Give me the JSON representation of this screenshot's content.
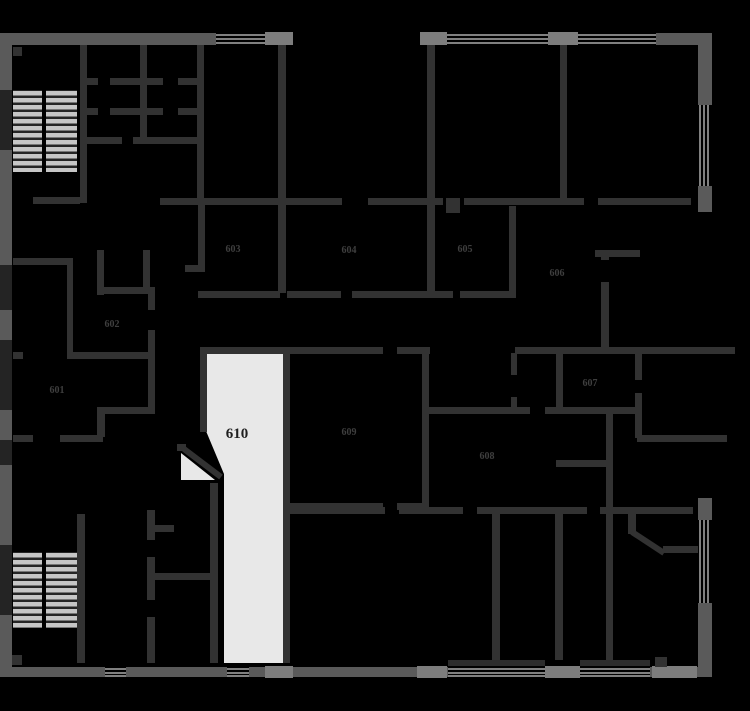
{
  "plan": {
    "type": "floor-plan",
    "highlighted_room": "610",
    "rooms": [
      {
        "id": "601",
        "label": "601"
      },
      {
        "id": "602",
        "label": "602"
      },
      {
        "id": "603",
        "label": "603"
      },
      {
        "id": "604",
        "label": "604"
      },
      {
        "id": "605",
        "label": "605"
      },
      {
        "id": "606",
        "label": "606"
      },
      {
        "id": "607",
        "label": "607"
      },
      {
        "id": "608",
        "label": "608"
      },
      {
        "id": "609",
        "label": "609"
      },
      {
        "id": "610",
        "label": "610"
      }
    ]
  },
  "colors": {
    "background": "#000000",
    "inner_wall": "#323232",
    "outer_wall": "#5a5a5a",
    "pier": "#7d7d7d",
    "window_line": "#808080",
    "stair_tread": "#c6c6c6",
    "stair_gap": "#252525",
    "highlight_room_fill": "#e8e8e8",
    "room_label": "#3f3f3f",
    "highlight_room_label": "#1f1f1f"
  }
}
